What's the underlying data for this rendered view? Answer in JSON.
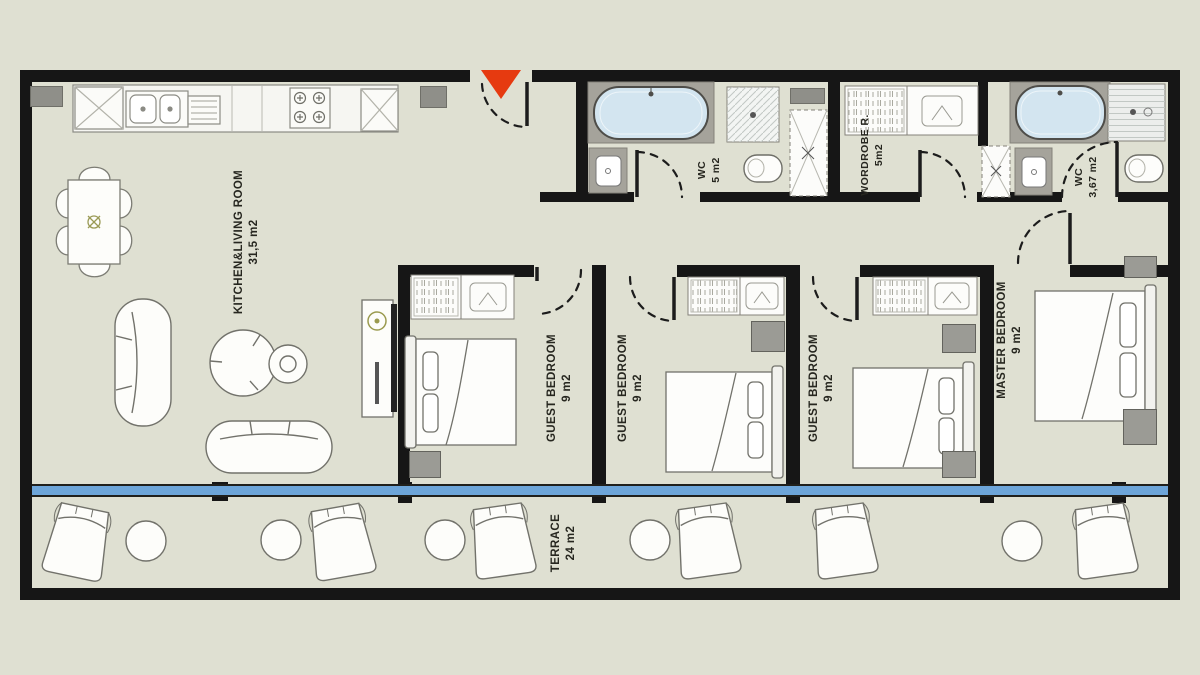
{
  "plan_title": "Apartment floor plan",
  "rooms": {
    "kitchen_living": {
      "name": "KITCHEN&LIVING ROOM",
      "area": "31,5 m2"
    },
    "wc1": {
      "name": "WC",
      "area": "5 m2"
    },
    "wardrobe": {
      "name": "WORDROBE R.",
      "area": "5m2"
    },
    "wc2": {
      "name": "WC",
      "area": "3,67 m2"
    },
    "guest1": {
      "name": "GUEST BEDROOM",
      "area": "9 m2"
    },
    "guest2": {
      "name": "GUEST BEDROOM",
      "area": "9 m2"
    },
    "guest3": {
      "name": "GUEST BEDROOM",
      "area": "9 m2"
    },
    "master": {
      "name": "MASTER BEDROOM",
      "area": "9 m2"
    },
    "terrace": {
      "name": "TERRACE",
      "area": "24 m2"
    }
  },
  "colors": {
    "background": "#dfe0d2",
    "wall": "#161616",
    "glass_line": "#6da5d9",
    "entrance_marker": "#e63a10",
    "bathtub_fill": "#d3e5f0",
    "column_gray": "#8f8f89",
    "furniture_stroke": "#72726b"
  },
  "markers": {
    "entrance": "entrance-triangle"
  }
}
